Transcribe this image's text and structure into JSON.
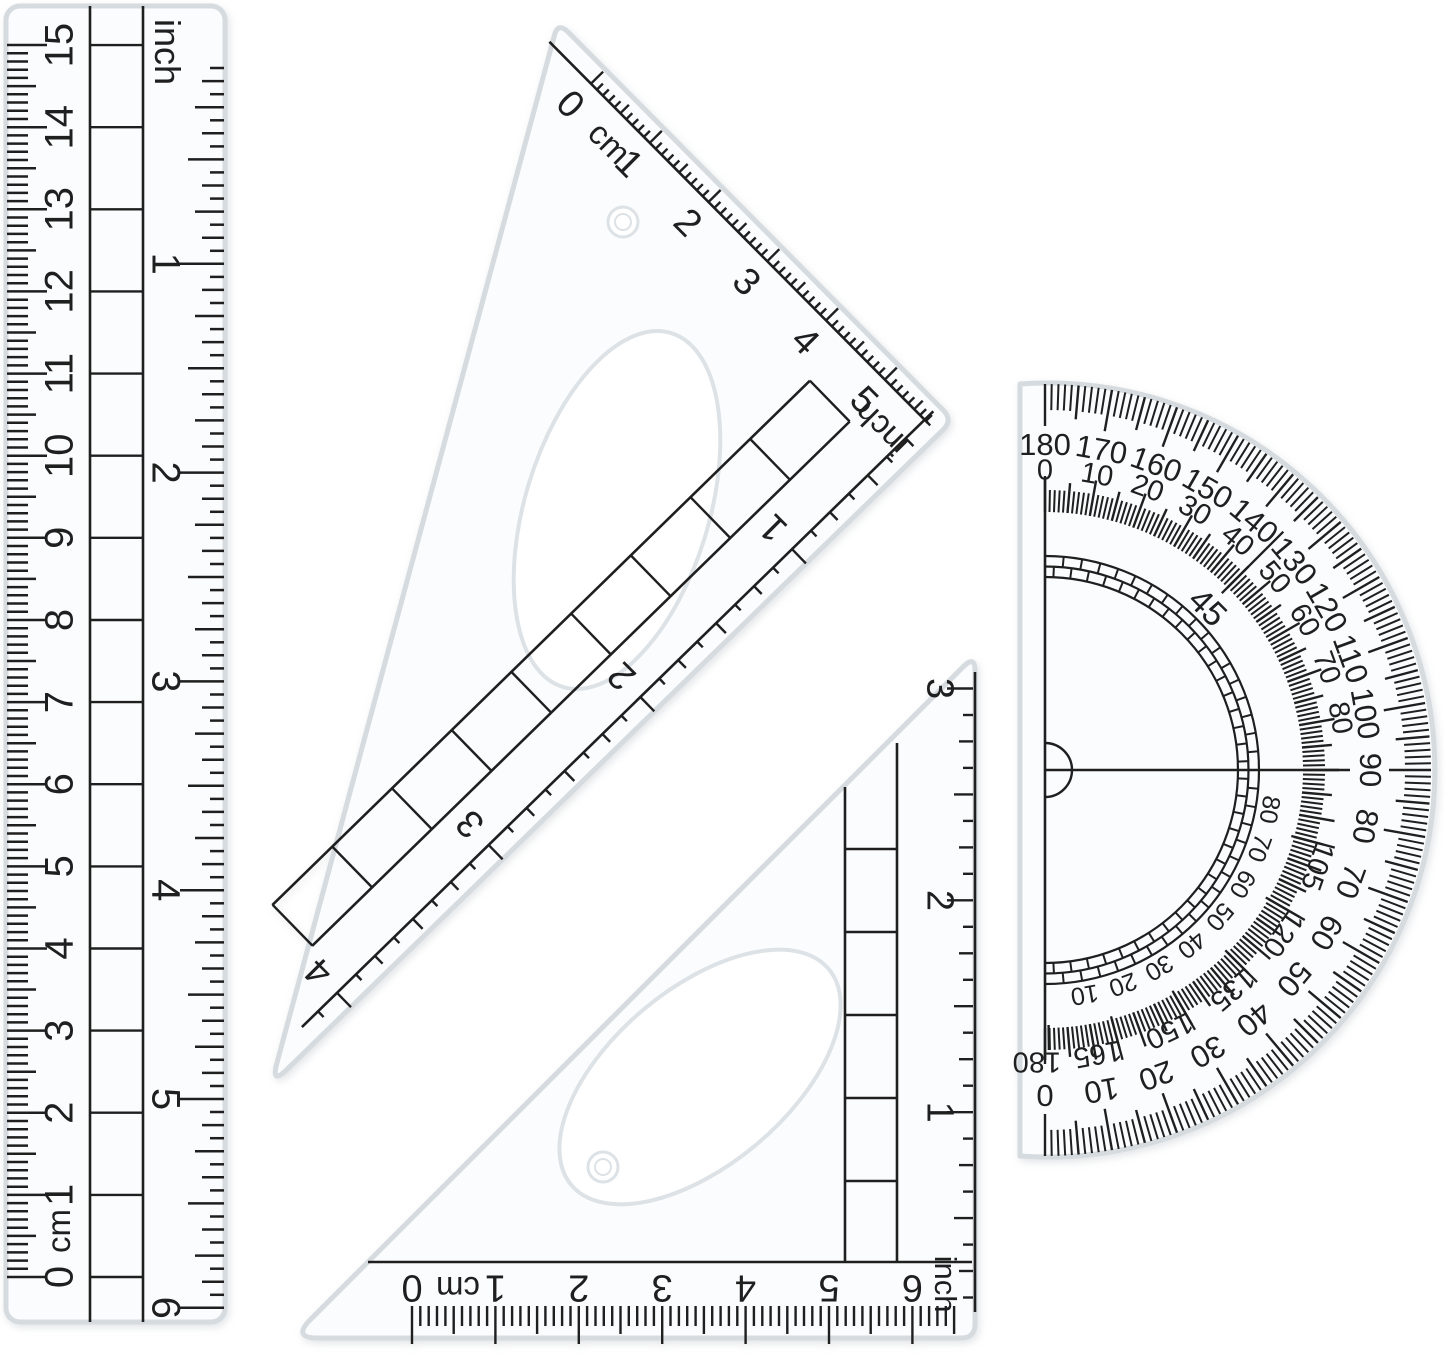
{
  "colors": {
    "ink": "#1f1f1f",
    "plastic_edge": "#d6dbdf",
    "plastic_fill": "#fbfcfd",
    "hole_edge": "#dde2e6",
    "background": "#ffffff"
  },
  "ruler": {
    "unit_cm_label": "cm",
    "unit_inch_label": "inch",
    "cm_labels": [
      "0",
      "1",
      "2",
      "3",
      "4",
      "5",
      "6",
      "7",
      "8",
      "9",
      "10",
      "11",
      "12",
      "13",
      "14",
      "15"
    ],
    "inch_labels": [
      "1",
      "2",
      "3",
      "4",
      "5",
      "6"
    ]
  },
  "set_square_60": {
    "cm_zero_label": "0",
    "unit_cm_label": "cm",
    "cm_labels": [
      "1",
      "2",
      "3",
      "4",
      "5"
    ],
    "unit_inch_label": "inch",
    "inch_labels": [
      "1",
      "2",
      "3",
      "4"
    ]
  },
  "set_square_45": {
    "cm_zero_label": "0",
    "unit_cm_label": "cm",
    "cm_labels": [
      "1",
      "2",
      "3",
      "4",
      "5",
      "6"
    ],
    "unit_inch_label": "inch",
    "inch_labels": [
      "1",
      "2",
      "3"
    ]
  },
  "protractor": {
    "outer_labels": [
      "180",
      "170",
      "160",
      "150",
      "140",
      "130",
      "120",
      "110",
      "100",
      "90",
      "80",
      "70",
      "60",
      "50",
      "40",
      "30",
      "20",
      "10",
      "0"
    ],
    "inner_top_labels": [
      "0",
      "10",
      "20",
      "30",
      "40",
      "50",
      "60",
      "70",
      "80"
    ],
    "inner_bottom_labels": [
      "105",
      "120",
      "135",
      "150",
      "165",
      "180"
    ],
    "mid_label": "45",
    "quadrant_labels": [
      "80",
      "70",
      "60",
      "50",
      "40",
      "30",
      "20",
      "10"
    ]
  }
}
